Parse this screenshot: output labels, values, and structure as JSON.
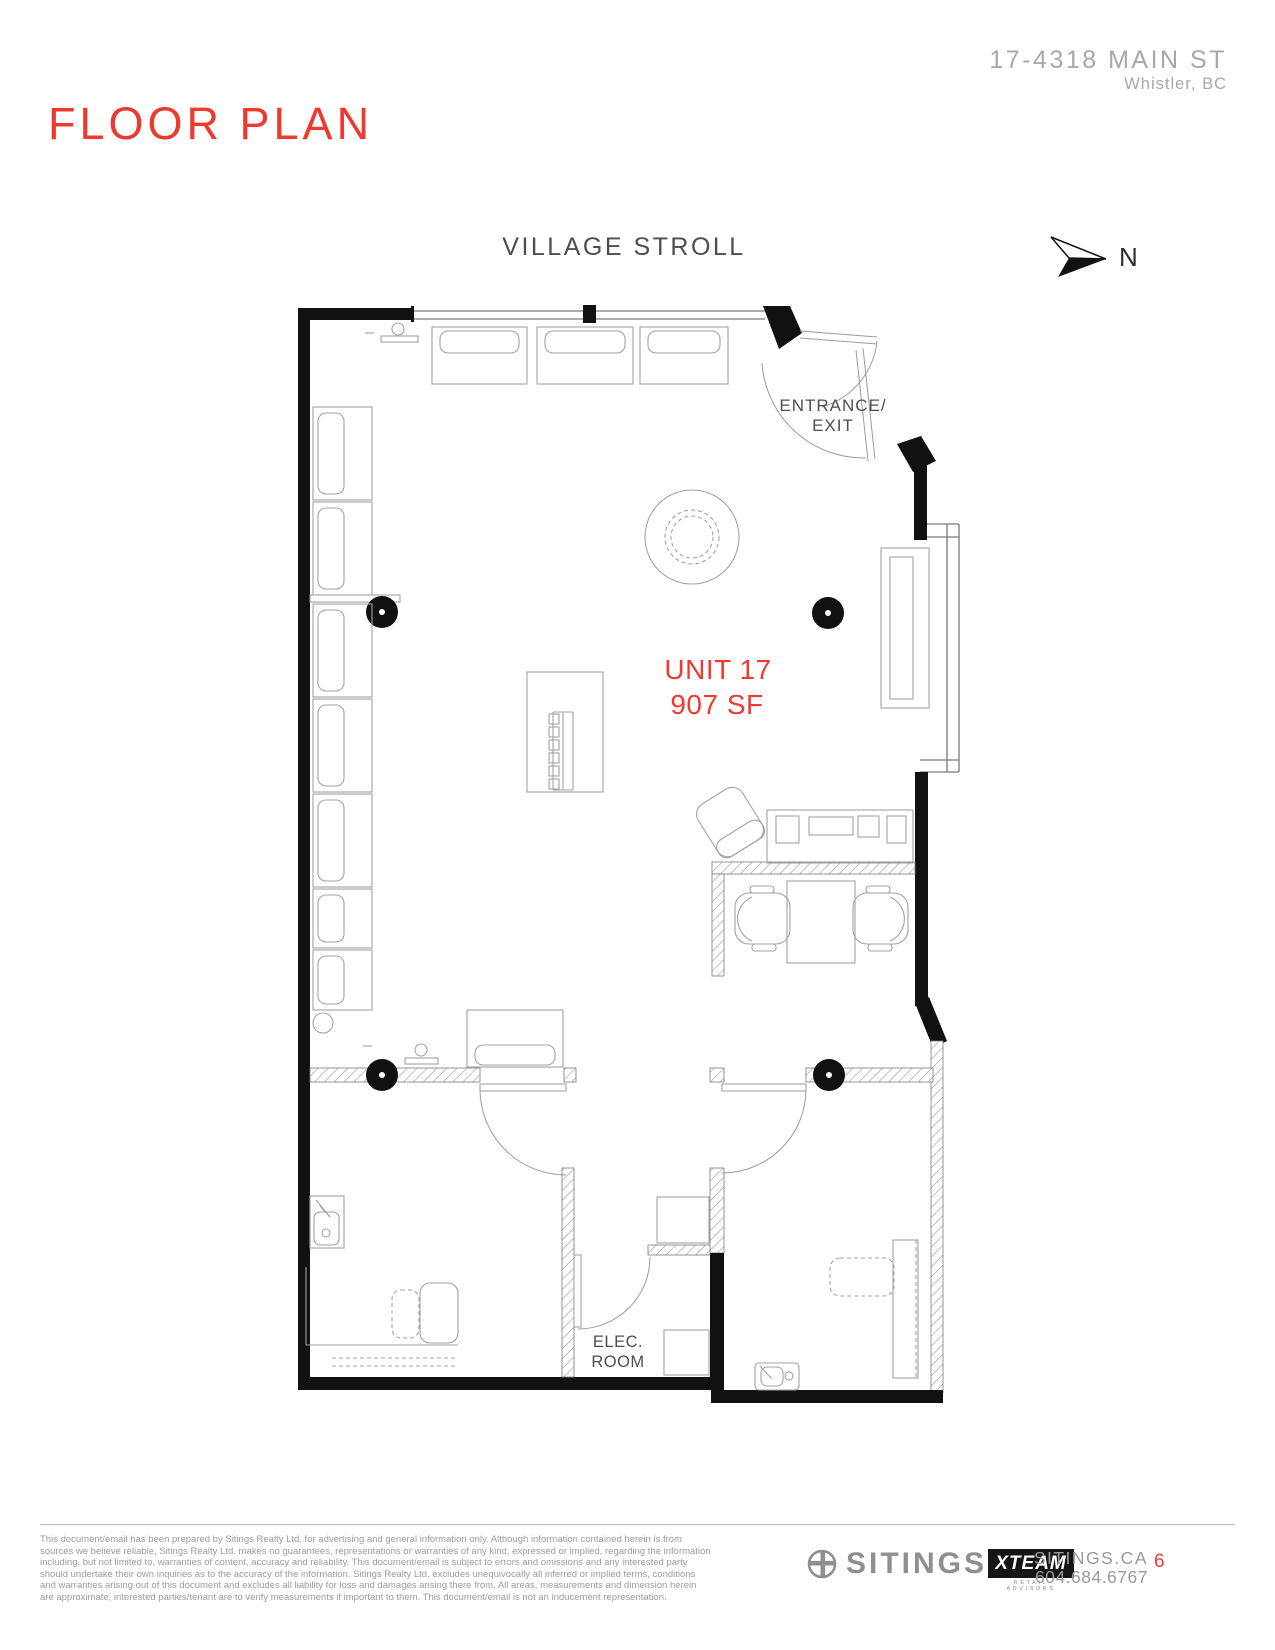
{
  "header": {
    "title": "FLOOR PLAN",
    "address_line1": "17-4318 MAIN ST",
    "address_line2": "Whistler, BC"
  },
  "plan": {
    "street_label": "VILLAGE STROLL",
    "north_label": "N",
    "entrance_line1": "ENTRANCE/",
    "entrance_line2": "EXIT",
    "unit_label": "UNIT 17",
    "unit_area": "907 SF",
    "elec_line1": "ELEC.",
    "elec_line2": "ROOM"
  },
  "footer": {
    "disclaimer_lines": [
      "This document/email has been prepared by Sitings Realty Ltd. for advertising and general information only. Although information contained herein is from",
      "sources we believe reliable, Sitings Realty Ltd. makes no guarantees, representations or warranties of any kind, expressed or implied, regarding the information",
      "including, but not limited to, warranties of content, accuracy and reliability. This document/email is subject to errors and omissions and any interested party",
      "should undertake their own inquiries as to the accuracy of the information. Sitings Realty Ltd. excludes unequivocally all inferred or implied terms, conditions",
      "and warranties arising out of this document and excludes all liability for loss and damages arising there from. All areas, measurements and dimension herein",
      "are approximate, interested parties/tenant are to verify measurements if important to them. This document/email is not an inducement representation."
    ],
    "sitings_logo_text": "SITINGS",
    "xteam_logo_text": "XTEAM",
    "xteam_tagline": "RETAIL ADVISORS",
    "website": "SITINGS.CA",
    "phone": "604.684.6767",
    "page_number": "6"
  },
  "colors": {
    "accent_red": "#ee3a30",
    "wall_black": "#111111",
    "label_gray": "#4e4e4e",
    "muted_gray": "#9b9b9b"
  }
}
